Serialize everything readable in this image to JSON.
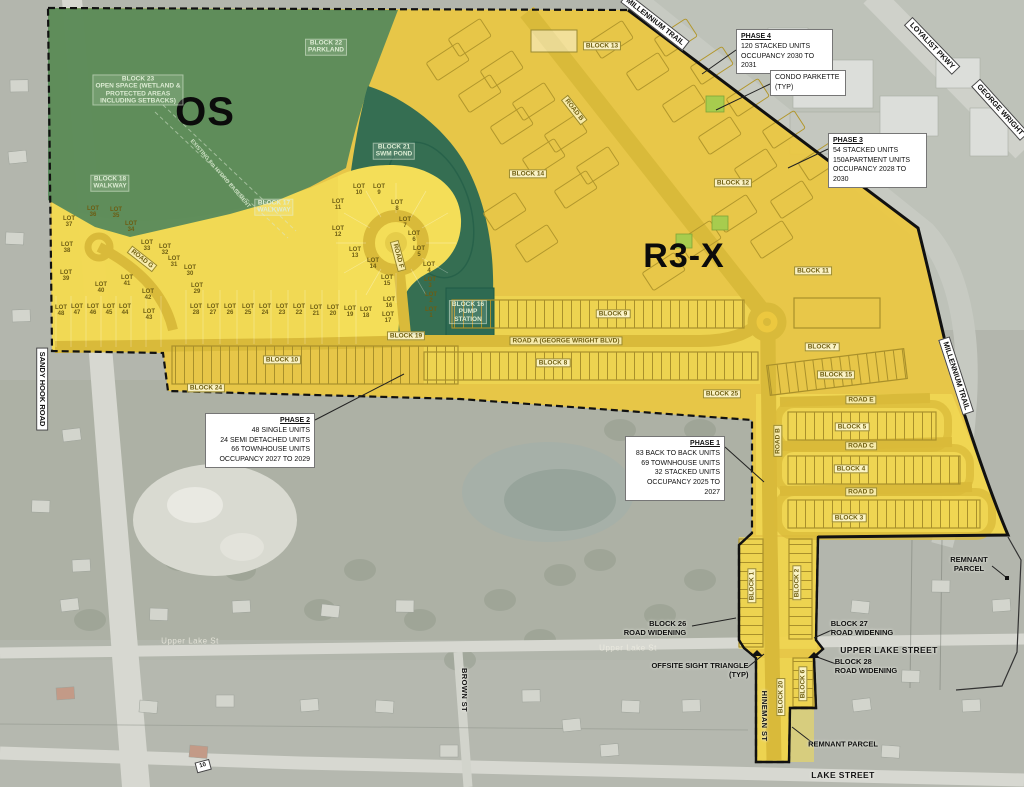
{
  "map": {
    "colors": {
      "os_green": "#578a5c",
      "swm_pond_green": "#2e6a52",
      "residential_yellow": "#ecc83f",
      "lots_yellow": "#f4de58",
      "road_yellow": "#d9ba3a",
      "boundary_black": "#111111",
      "callout_white": "#ffffff"
    },
    "labels": [
      {
        "t": "OS",
        "x": 205,
        "y": 112,
        "c": "zone",
        "f": 40,
        "n": "os-zone-label"
      },
      {
        "t": "R3-X",
        "x": 684,
        "y": 256,
        "c": "zone",
        "f": 34,
        "n": "r3x-zone-label"
      },
      {
        "t": "BLOCK 23\nOPEN SPACE (WETLAND &\nPROTECTED AREAS\nINCLUDING SETBACKS)",
        "x": 138,
        "y": 90,
        "c": "bg",
        "n": "block-23-open-space-label"
      },
      {
        "t": "BLOCK 22\nPARKLAND",
        "x": 326,
        "y": 47,
        "c": "bg",
        "n": "block-22-parkland-label"
      },
      {
        "t": "BLOCK 18\nWALKWAY",
        "x": 110,
        "y": 183,
        "c": "bg",
        "n": "block-18-walkway-label"
      },
      {
        "t": "BLOCK 17\nWALKWAY",
        "x": 274,
        "y": 207,
        "c": "bg",
        "n": "block-17-walkway-label"
      },
      {
        "t": "BLOCK 21\nSWM POND",
        "x": 394,
        "y": 151,
        "c": "bg",
        "n": "block-21-swm-pond-label"
      },
      {
        "t": "BLOCK 16\nPUMP\nSTATION",
        "x": 468,
        "y": 312,
        "c": "bg",
        "n": "block-16-pump-station-label"
      },
      {
        "t": "EXISTING 8m HYDRO EASEMENT",
        "x": 220,
        "y": 174,
        "c": "bgn",
        "r": 49,
        "n": "hydro-easement-label"
      },
      {
        "t": "BLOCK 13",
        "x": 602,
        "y": 46,
        "c": "by",
        "n": "block-13-label"
      },
      {
        "t": "BLOCK 14",
        "x": 528,
        "y": 174,
        "c": "by",
        "n": "block-14-label"
      },
      {
        "t": "BLOCK 12",
        "x": 733,
        "y": 183,
        "c": "by",
        "n": "block-12-label"
      },
      {
        "t": "BLOCK 11",
        "x": 813,
        "y": 271,
        "c": "by",
        "n": "block-11-label"
      },
      {
        "t": "BLOCK 7",
        "x": 822,
        "y": 347,
        "c": "by",
        "n": "block-7-label"
      },
      {
        "t": "BLOCK 15",
        "x": 836,
        "y": 375,
        "c": "by",
        "n": "block-15-label"
      },
      {
        "t": "BLOCK 9",
        "x": 613,
        "y": 314,
        "c": "by",
        "n": "block-9-label"
      },
      {
        "t": "BLOCK 8",
        "x": 553,
        "y": 363,
        "c": "by",
        "n": "block-8-label"
      },
      {
        "t": "BLOCK 19",
        "x": 406,
        "y": 336,
        "c": "by",
        "n": "block-19-label"
      },
      {
        "t": "BLOCK 10",
        "x": 282,
        "y": 360,
        "c": "by",
        "n": "block-10-label"
      },
      {
        "t": "BLOCK 24",
        "x": 206,
        "y": 388,
        "c": "by",
        "n": "block-24-label"
      },
      {
        "t": "BLOCK 25",
        "x": 722,
        "y": 394,
        "c": "by",
        "n": "block-25-label"
      },
      {
        "t": "BLOCK 5",
        "x": 852,
        "y": 427,
        "c": "by",
        "n": "block-5-label"
      },
      {
        "t": "BLOCK 4",
        "x": 851,
        "y": 469,
        "c": "by",
        "n": "block-4-label"
      },
      {
        "t": "BLOCK 3",
        "x": 849,
        "y": 518,
        "c": "by",
        "n": "block-3-label"
      },
      {
        "t": "BLOCK 1",
        "x": 752,
        "y": 586,
        "c": "by",
        "r": -90,
        "n": "block-1-label"
      },
      {
        "t": "BLOCK 2",
        "x": 797,
        "y": 583,
        "c": "by",
        "r": -90,
        "n": "block-2-label"
      },
      {
        "t": "BLOCK 20",
        "x": 781,
        "y": 697,
        "c": "by",
        "r": -90,
        "n": "block-20-label"
      },
      {
        "t": "BLOCK 6",
        "x": 803,
        "y": 684,
        "c": "by",
        "r": -90,
        "n": "block-6-label"
      },
      {
        "t": "ROAD A (GEORGE WRIGHT BLVD)",
        "x": 566,
        "y": 341,
        "c": "ry",
        "n": "road-a-label"
      },
      {
        "t": "ROAD B",
        "x": 574,
        "y": 110,
        "c": "ry",
        "r": 52,
        "n": "road-b-diagonal-label"
      },
      {
        "t": "ROAD B",
        "x": 778,
        "y": 441,
        "c": "ry",
        "r": -90,
        "n": "road-b-vertical-label"
      },
      {
        "t": "ROAD E",
        "x": 861,
        "y": 400,
        "c": "ry",
        "n": "road-e-label"
      },
      {
        "t": "ROAD C",
        "x": 861,
        "y": 446,
        "c": "ry",
        "n": "road-c-label"
      },
      {
        "t": "ROAD D",
        "x": 861,
        "y": 492,
        "c": "ry",
        "n": "road-d-label"
      },
      {
        "t": "ROAD F",
        "x": 398,
        "y": 256,
        "c": "ry",
        "r": 75,
        "n": "road-f-label"
      },
      {
        "t": "ROAD G",
        "x": 142,
        "y": 259,
        "c": "ry",
        "r": 38,
        "n": "road-g-label"
      },
      {
        "t": "SANDY HOOK ROAD",
        "x": 42,
        "y": 389,
        "c": "sb",
        "r": 90,
        "n": "sandy-hook-road-label"
      },
      {
        "t": "MILLENNIUM TRAIL",
        "x": 655,
        "y": 22,
        "c": "sb",
        "r": 38,
        "n": "millennium-trail-top-label"
      },
      {
        "t": "MILLENNIUM TRAIL",
        "x": 956,
        "y": 376,
        "c": "sb",
        "r": 72,
        "n": "millennium-trail-right-label"
      },
      {
        "t": "LOYALIST PKWY",
        "x": 932,
        "y": 46,
        "c": "sb",
        "r": 46,
        "n": "loyalist-pkwy-label"
      },
      {
        "t": "GEORGE WRIGHT",
        "x": 1000,
        "y": 110,
        "c": "sb",
        "r": 48,
        "n": "george-wright-label"
      },
      {
        "t": "10",
        "x": 203,
        "y": 766,
        "c": "sb",
        "r": -15,
        "f": 6,
        "n": "route-10-marker"
      },
      {
        "t": "UPPER LAKE STREET",
        "x": 889,
        "y": 651,
        "c": "st",
        "n": "upper-lake-street-label"
      },
      {
        "t": "LAKE STREET",
        "x": 843,
        "y": 776,
        "c": "st",
        "n": "lake-street-label"
      },
      {
        "t": "HINEMAN ST",
        "x": 764,
        "y": 716,
        "c": "st",
        "r": 90,
        "f": 7.5,
        "n": "hineman-st-label"
      },
      {
        "t": "BROWN ST",
        "x": 464,
        "y": 690,
        "c": "st",
        "r": 90,
        "f": 7.5,
        "n": "brown-st-label"
      },
      {
        "t": "Upper Lake St",
        "x": 190,
        "y": 642,
        "c": "sf",
        "n": "upper-lake-st-faint-west"
      },
      {
        "t": "Upper Lake St",
        "x": 628,
        "y": 649,
        "c": "sf",
        "n": "upper-lake-st-faint-east"
      },
      {
        "t": "BLOCK 26\nROAD WIDENING",
        "x": 655,
        "y": 628,
        "c": "an",
        "a": "right",
        "n": "block-26-road-widening-label"
      },
      {
        "t": "BLOCK 27\nROAD WIDENING",
        "x": 862,
        "y": 628,
        "c": "an",
        "a": "left",
        "n": "block-27-road-widening-label"
      },
      {
        "t": "BLOCK 28\nROAD WIDENING",
        "x": 866,
        "y": 666,
        "c": "an",
        "a": "left",
        "n": "block-28-road-widening-label"
      },
      {
        "t": "OFFSITE SIGHT TRIANGLE\n(TYP)",
        "x": 700,
        "y": 670,
        "c": "an",
        "a": "right",
        "n": "offsite-sight-triangle-label"
      },
      {
        "t": "REMNANT\nPARCEL",
        "x": 969,
        "y": 564,
        "c": "an",
        "n": "remnant-parcel-east-label"
      },
      {
        "t": "REMNANT PARCEL",
        "x": 843,
        "y": 744,
        "c": "an",
        "n": "remnant-parcel-south-label"
      },
      {
        "t": "LOT\n1",
        "x": 431,
        "y": 313,
        "c": "lot",
        "n": "lot-1"
      },
      {
        "t": "LOT\n2",
        "x": 431,
        "y": 298,
        "c": "lot",
        "n": "lot-2"
      },
      {
        "t": "LOT\n3",
        "x": 430,
        "y": 283,
        "c": "lot",
        "n": "lot-3"
      },
      {
        "t": "LOT\n4",
        "x": 429,
        "y": 268,
        "c": "lot",
        "n": "lot-4"
      },
      {
        "t": "LOT\n5",
        "x": 419,
        "y": 252,
        "c": "lot",
        "n": "lot-5"
      },
      {
        "t": "LOT\n6",
        "x": 414,
        "y": 237,
        "c": "lot",
        "n": "lot-6"
      },
      {
        "t": "LOT\n7",
        "x": 405,
        "y": 223,
        "c": "lot",
        "n": "lot-7"
      },
      {
        "t": "LOT\n8",
        "x": 397,
        "y": 206,
        "c": "lot",
        "n": "lot-8"
      },
      {
        "t": "LOT\n9",
        "x": 379,
        "y": 190,
        "c": "lot",
        "n": "lot-9"
      },
      {
        "t": "LOT\n10",
        "x": 359,
        "y": 190,
        "c": "lot",
        "n": "lot-10"
      },
      {
        "t": "LOT\n11",
        "x": 338,
        "y": 205,
        "c": "lot",
        "n": "lot-11"
      },
      {
        "t": "LOT\n12",
        "x": 338,
        "y": 232,
        "c": "lot",
        "n": "lot-12"
      },
      {
        "t": "LOT\n13",
        "x": 355,
        "y": 253,
        "c": "lot",
        "n": "lot-13"
      },
      {
        "t": "LOT\n14",
        "x": 373,
        "y": 264,
        "c": "lot",
        "n": "lot-14"
      },
      {
        "t": "LOT\n15",
        "x": 387,
        "y": 281,
        "c": "lot",
        "n": "lot-15"
      },
      {
        "t": "LOT\n16",
        "x": 389,
        "y": 303,
        "c": "lot",
        "n": "lot-16"
      },
      {
        "t": "LOT\n17",
        "x": 388,
        "y": 318,
        "c": "lot",
        "n": "lot-17"
      },
      {
        "t": "LOT\n18",
        "x": 366,
        "y": 313,
        "c": "lot",
        "n": "lot-18"
      },
      {
        "t": "LOT\n19",
        "x": 350,
        "y": 312,
        "c": "lot",
        "n": "lot-19"
      },
      {
        "t": "LOT\n20",
        "x": 333,
        "y": 311,
        "c": "lot",
        "n": "lot-20"
      },
      {
        "t": "LOT\n21",
        "x": 316,
        "y": 311,
        "c": "lot",
        "n": "lot-21"
      },
      {
        "t": "LOT\n22",
        "x": 299,
        "y": 310,
        "c": "lot",
        "n": "lot-22"
      },
      {
        "t": "LOT\n23",
        "x": 282,
        "y": 310,
        "c": "lot",
        "n": "lot-23"
      },
      {
        "t": "LOT\n24",
        "x": 265,
        "y": 310,
        "c": "lot",
        "n": "lot-24"
      },
      {
        "t": "LOT\n25",
        "x": 248,
        "y": 310,
        "c": "lot",
        "n": "lot-25"
      },
      {
        "t": "LOT\n26",
        "x": 230,
        "y": 310,
        "c": "lot",
        "n": "lot-26"
      },
      {
        "t": "LOT\n27",
        "x": 213,
        "y": 310,
        "c": "lot",
        "n": "lot-27"
      },
      {
        "t": "LOT\n28",
        "x": 196,
        "y": 310,
        "c": "lot",
        "n": "lot-28"
      },
      {
        "t": "LOT\n29",
        "x": 197,
        "y": 289,
        "c": "lot",
        "n": "lot-29"
      },
      {
        "t": "LOT\n30",
        "x": 190,
        "y": 271,
        "c": "lot",
        "n": "lot-30"
      },
      {
        "t": "LOT\n31",
        "x": 174,
        "y": 262,
        "c": "lot",
        "n": "lot-31"
      },
      {
        "t": "LOT\n32",
        "x": 165,
        "y": 250,
        "c": "lot",
        "n": "lot-32"
      },
      {
        "t": "LOT\n33",
        "x": 147,
        "y": 246,
        "c": "lot",
        "n": "lot-33"
      },
      {
        "t": "LOT\n34",
        "x": 131,
        "y": 227,
        "c": "lot",
        "n": "lot-34"
      },
      {
        "t": "LOT\n35",
        "x": 116,
        "y": 213,
        "c": "lot",
        "n": "lot-35"
      },
      {
        "t": "LOT\n36",
        "x": 93,
        "y": 212,
        "c": "lot",
        "n": "lot-36"
      },
      {
        "t": "LOT\n37",
        "x": 69,
        "y": 222,
        "c": "lot",
        "n": "lot-37"
      },
      {
        "t": "LOT\n38",
        "x": 67,
        "y": 248,
        "c": "lot",
        "n": "lot-38"
      },
      {
        "t": "LOT\n39",
        "x": 66,
        "y": 276,
        "c": "lot",
        "n": "lot-39"
      },
      {
        "t": "LOT\n40",
        "x": 101,
        "y": 288,
        "c": "lot",
        "n": "lot-40"
      },
      {
        "t": "LOT\n41",
        "x": 127,
        "y": 281,
        "c": "lot",
        "n": "lot-41"
      },
      {
        "t": "LOT\n42",
        "x": 148,
        "y": 295,
        "c": "lot",
        "n": "lot-42"
      },
      {
        "t": "LOT\n43",
        "x": 149,
        "y": 315,
        "c": "lot",
        "n": "lot-43"
      },
      {
        "t": "LOT\n44",
        "x": 125,
        "y": 310,
        "c": "lot",
        "n": "lot-44"
      },
      {
        "t": "LOT\n45",
        "x": 109,
        "y": 310,
        "c": "lot",
        "n": "lot-45"
      },
      {
        "t": "LOT\n46",
        "x": 93,
        "y": 310,
        "c": "lot",
        "n": "lot-46"
      },
      {
        "t": "LOT\n47",
        "x": 77,
        "y": 310,
        "c": "lot",
        "n": "lot-47"
      },
      {
        "t": "LOT\n48",
        "x": 61,
        "y": 311,
        "c": "lot",
        "n": "lot-48"
      }
    ],
    "callouts": [
      {
        "x": 736,
        "y": 29,
        "w": 97,
        "a": "left",
        "u": true,
        "n": "phase-4-callout",
        "lines": [
          "PHASE 4",
          "120 STACKED UNITS",
          "OCCUPANCY 2030 TO 2031"
        ]
      },
      {
        "x": 770,
        "y": 70,
        "w": 76,
        "a": "left",
        "u": false,
        "n": "condo-parkette-callout",
        "lines": [
          "CONDO PARKETTE",
          "(TYP)"
        ]
      },
      {
        "x": 828,
        "y": 133,
        "w": 99,
        "a": "left",
        "u": true,
        "n": "phase-3-callout",
        "lines": [
          "PHASE 3",
          "54 STACKED UNITS",
          "150APARTMENT UNITS",
          "OCCUPANCY 2028 TO 2030"
        ]
      },
      {
        "x": 205,
        "y": 413,
        "w": 110,
        "a": "right",
        "u": true,
        "n": "phase-2-callout",
        "lines": [
          "PHASE 2",
          "48 SINGLE UNITS",
          "24 SEMI DETACHED UNITS",
          "66 TOWNHOUSE UNITS",
          "OCCUPANCY 2027 TO 2029"
        ]
      },
      {
        "x": 625,
        "y": 436,
        "w": 100,
        "a": "right",
        "u": true,
        "n": "phase-1-callout",
        "lines": [
          "PHASE 1",
          "83 BACK TO BACK UNITS",
          "69 TOWNHOUSE UNITS",
          "32 STACKED UNITS",
          "OCCUPANCY 2025 TO 2027"
        ]
      }
    ]
  }
}
